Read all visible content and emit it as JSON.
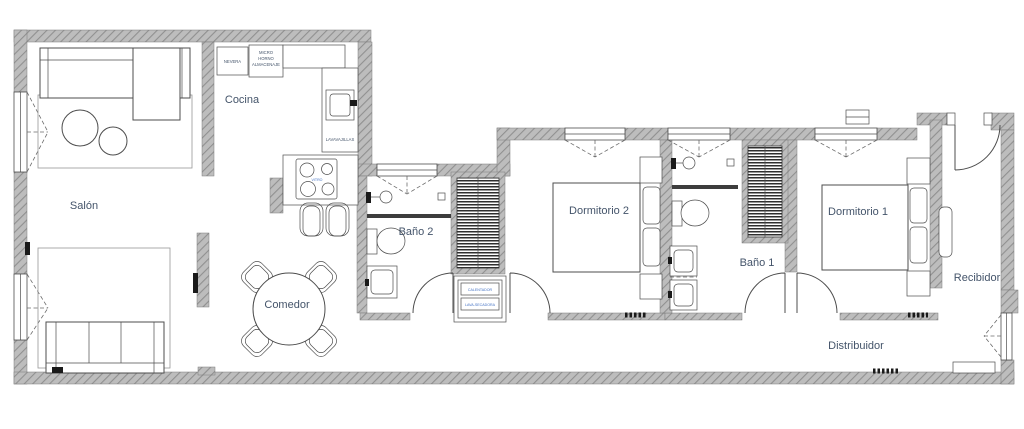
{
  "colors": {
    "wall_fill": "#bdbdbd",
    "wall_hatch": "#909090",
    "line": "#4d4d4d",
    "label_text": "#44546A",
    "tiny_text": "#4472C4",
    "background": "#ffffff"
  },
  "rooms": {
    "salon": "Salón",
    "cocina": "Cocina",
    "comedor": "Comedor",
    "bano2": "Baño 2",
    "dormitorio2": "Dormitorio 2",
    "bano1": "Baño 1",
    "dormitorio1": "Dormitorio 1",
    "recibidor": "Recibidor",
    "distribuidor": "Distribuidor"
  },
  "kitchen": {
    "nevera": "NEVERA",
    "micro": "MICRO",
    "horno": "HORNO",
    "almacenaje": "ALMACENAJE",
    "lavavajillas": "LAVAVAJILLAS",
    "vitro": "VITRO"
  },
  "utility": {
    "calentador": "CALENTADOR",
    "lava_secadora": "LAVA-SECADORA"
  }
}
